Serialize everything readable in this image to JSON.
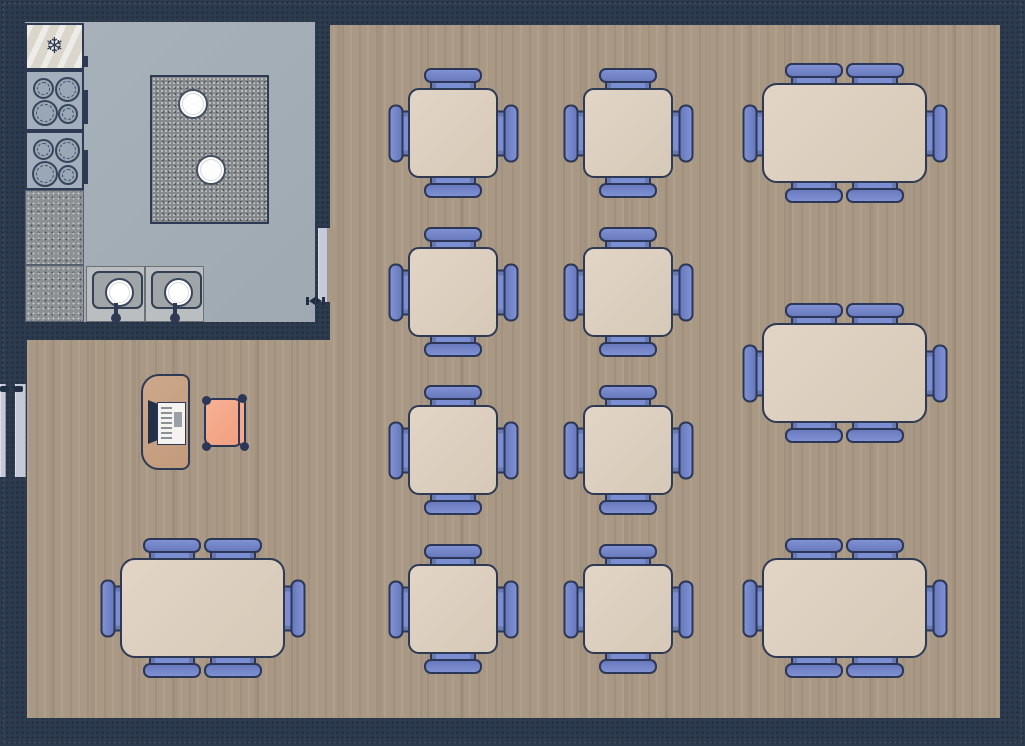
{
  "scene": {
    "kind": "restaurant-floor-plan",
    "rooms": [
      {
        "name": "kitchen",
        "floor": "tile",
        "floor_color": "#a4aeb6"
      },
      {
        "name": "dining-room",
        "floor": "wood",
        "floor_color": "#a99884"
      }
    ]
  },
  "colors": {
    "wall": "#2d3b4f",
    "wood_floor": "#a99884",
    "kitchen_floor": "#a4aeb6",
    "table_fill": "#dccfbf",
    "table_outline": "#2e3a54",
    "chair_fill": "#7b8ed1",
    "chair_outline": "#2c3757",
    "door_leaf": "#c6c9d8",
    "desk_fill": "#c8a184",
    "host_chair_fill": "#f4a98b",
    "island_fill": "#85898c",
    "stove_fill": "#a4afbd",
    "fridge_fill": "#dad6cc"
  },
  "icons": {
    "snowflake_glyph": "❄"
  },
  "furniture": {
    "tables_for_four": [
      {
        "id": "T1",
        "x": 408,
        "y": 88
      },
      {
        "id": "T2",
        "x": 583,
        "y": 88
      },
      {
        "id": "T3",
        "x": 408,
        "y": 247
      },
      {
        "id": "T4",
        "x": 583,
        "y": 247
      },
      {
        "id": "T5",
        "x": 408,
        "y": 405
      },
      {
        "id": "T6",
        "x": 583,
        "y": 405
      },
      {
        "id": "T7",
        "x": 408,
        "y": 564
      },
      {
        "id": "T8",
        "x": 583,
        "y": 564
      }
    ],
    "tables_for_six": [
      {
        "id": "B1",
        "x": 762,
        "y": 83
      },
      {
        "id": "B2",
        "x": 762,
        "y": 323
      },
      {
        "id": "B3",
        "x": 762,
        "y": 558
      },
      {
        "id": "B4",
        "x": 120,
        "y": 558
      }
    ],
    "table_four_size": {
      "w": 90,
      "h": 90,
      "seats": 4
    },
    "table_six_size": {
      "w": 165,
      "h": 100,
      "seats": 6
    },
    "host_station": {
      "desk": true,
      "cash_register": true,
      "office_chair": true
    }
  },
  "kitchen_fixtures": {
    "refrigerator": 1,
    "stoves": 2,
    "burners_per_stove": 4,
    "counters": 2,
    "island_with_stools": {
      "islands": 1,
      "stools": 2
    },
    "sinks": 2
  },
  "doors": {
    "entry_double_door_leaves": 2,
    "kitchen_door_leaves": 1
  }
}
